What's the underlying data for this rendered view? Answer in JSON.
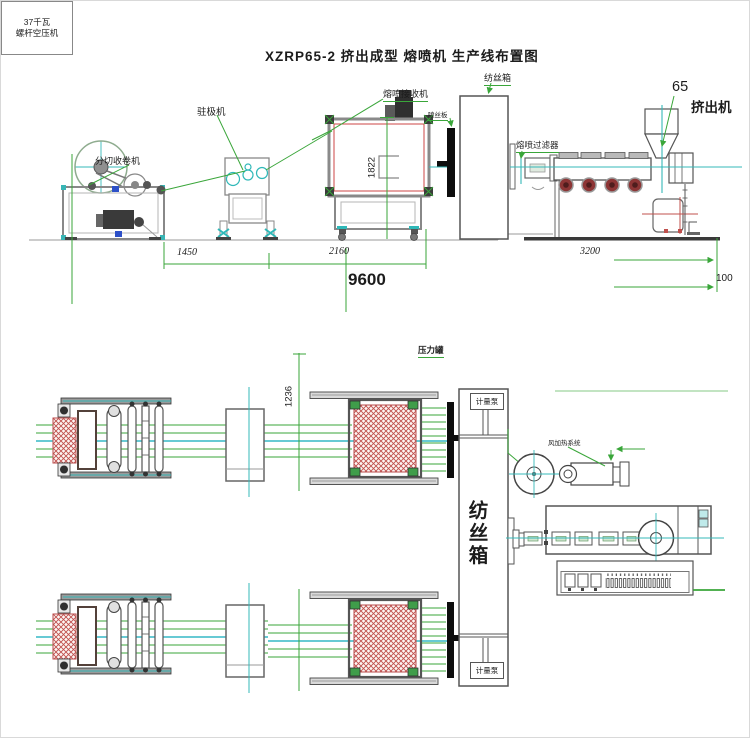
{
  "title": "XZRP65-2 挤出成型 熔喷机 生产线布置图",
  "side_view": {
    "labels": {
      "spinning_box": "纺丝箱",
      "receiver": "熔喷接收机",
      "electret": "驻极机",
      "winder": "分切收卷机",
      "spinneret": "喷丝板",
      "filter": "熔喷过滤器",
      "extruder_size": "65",
      "extruder": "挤出机"
    },
    "dims": {
      "d1450": "1450",
      "d2160": "2160",
      "d9600": "9600",
      "d3200": "3200",
      "d100": "100",
      "d1822": "1822"
    }
  },
  "plan_view": {
    "labels": {
      "pressure_tank": "压力罐",
      "metering_pump_top": "计量泵",
      "metering_pump_bottom": "计量泵",
      "air_heating": "风加热系统",
      "compressor_line1": "37千瓦",
      "compressor_line2": "螺杆空压机",
      "spinning_box": "纺丝箱"
    },
    "dims": {
      "d1236": "1236"
    }
  },
  "colors": {
    "dim_green": "#3aa63a",
    "centerline_teal": "#35b8b8",
    "hatch_red": "#c0504d",
    "frame_gray": "#666666"
  }
}
